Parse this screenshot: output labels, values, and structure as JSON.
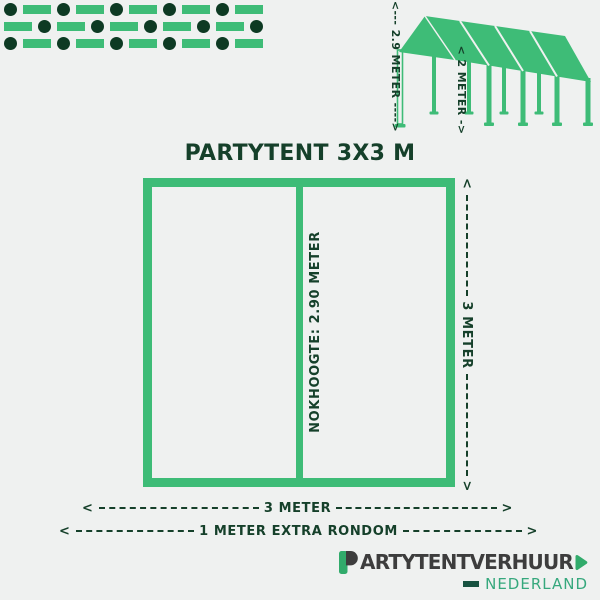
{
  "colors": {
    "bg": "#eff1f0",
    "green": "#3ebc77",
    "dark": "#15402a",
    "circle": "#0d3a23",
    "logotext": "#3d3d3d",
    "logogreen": "#31ab6b",
    "logoteal": "#36a87d",
    "logodark": "#175240"
  },
  "pattern": {
    "rows": [
      "CRCRCRCRCR",
      "RCRCRCRCRC",
      "CRCRCRCRCR"
    ]
  },
  "title": "PARTYTENT 3X3 M",
  "tent": {
    "height_label": "<--- 2.9 METER ---->",
    "bay_label": "< 2 METER ->"
  },
  "diagram": {
    "ridge_label": "NOKHOOGTE: 2.90 METER",
    "side_label": "3 METER",
    "width_label": "3 METER",
    "extra_label": "1 METER EXTRA RONDOM",
    "arrow_left": "<",
    "arrow_right": ">"
  },
  "logo": {
    "initial": "P",
    "name_rest": "ARTYTENTVERHUUR",
    "country": "NEDERLAND"
  }
}
